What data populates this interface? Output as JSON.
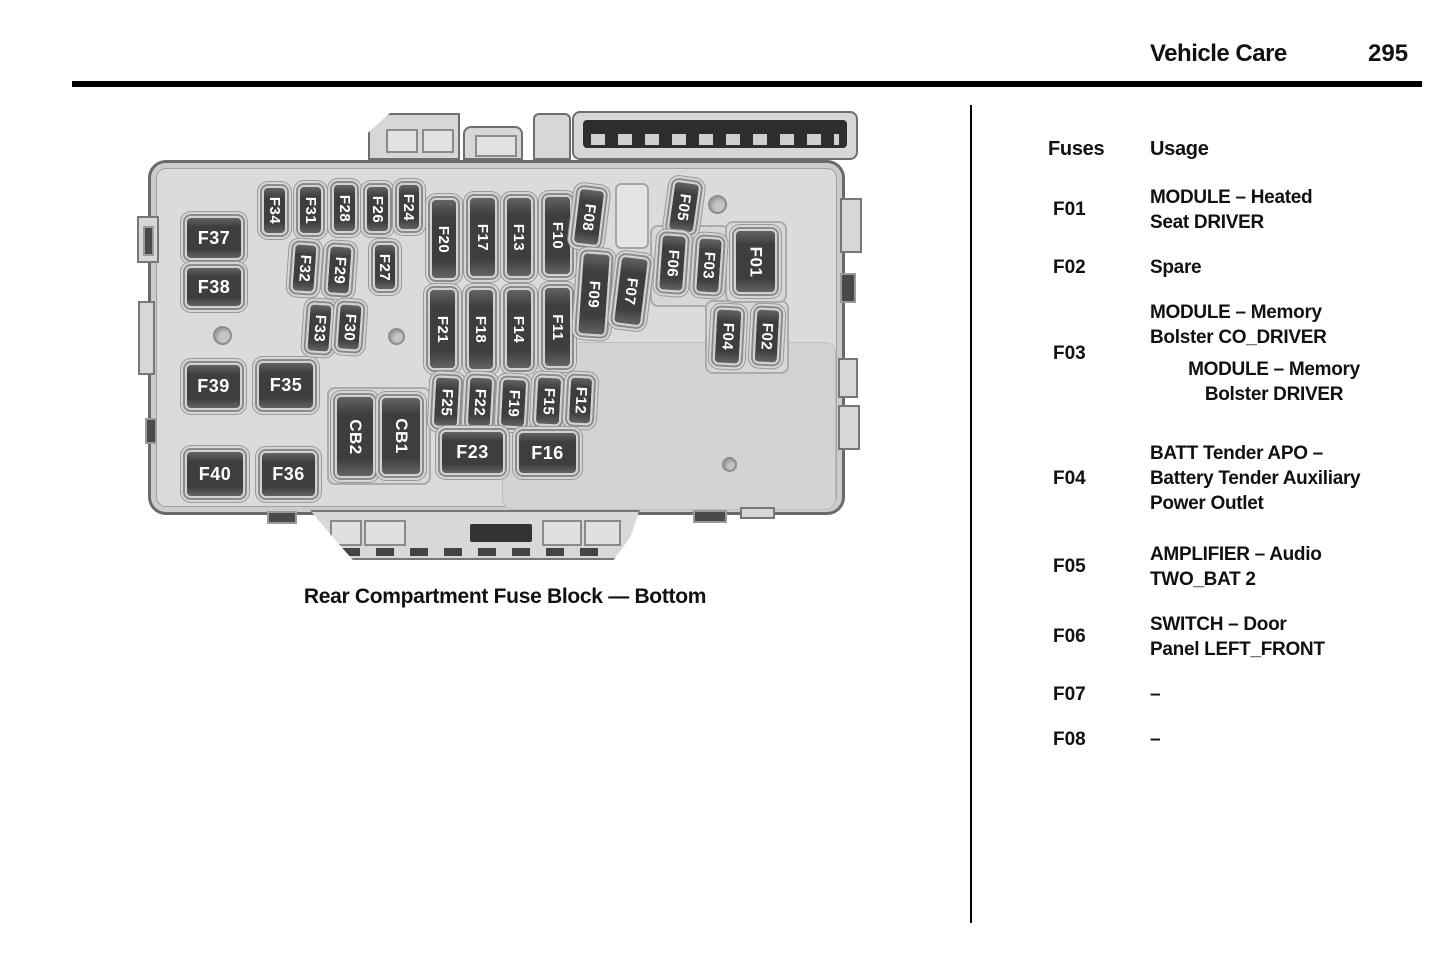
{
  "page_header": {
    "section_title": "Vehicle Care",
    "page_number": "295"
  },
  "diagram": {
    "caption": "Rear Compartment Fuse Block — Bottom",
    "fuses": [
      {
        "id": "F37",
        "x": 110,
        "y": 113,
        "w": 58,
        "h": 44,
        "o": "h"
      },
      {
        "id": "F38",
        "x": 110,
        "y": 163,
        "w": 58,
        "h": 42,
        "o": "h"
      },
      {
        "id": "F39",
        "x": 110,
        "y": 260,
        "w": 57,
        "h": 47,
        "o": "h"
      },
      {
        "id": "F35",
        "x": 182,
        "y": 258,
        "w": 58,
        "h": 49,
        "o": "h"
      },
      {
        "id": "F40",
        "x": 110,
        "y": 347,
        "w": 60,
        "h": 48,
        "o": "h"
      },
      {
        "id": "F36",
        "x": 185,
        "y": 348,
        "w": 57,
        "h": 47,
        "o": "h"
      },
      {
        "id": "F34",
        "x": 187,
        "y": 83,
        "w": 25,
        "h": 49,
        "o": "v"
      },
      {
        "id": "F31",
        "x": 223,
        "y": 82,
        "w": 25,
        "h": 50,
        "o": "v"
      },
      {
        "id": "F28",
        "x": 257,
        "y": 80,
        "w": 25,
        "h": 50,
        "o": "v"
      },
      {
        "id": "F26",
        "x": 290,
        "y": 82,
        "w": 25,
        "h": 48,
        "o": "v"
      },
      {
        "id": "F24",
        "x": 322,
        "y": 80,
        "w": 24,
        "h": 48,
        "o": "v"
      },
      {
        "id": "F32",
        "x": 217,
        "y": 140,
        "w": 25,
        "h": 50,
        "o": "v",
        "tilt": 4
      },
      {
        "id": "F29",
        "x": 252,
        "y": 142,
        "w": 25,
        "h": 50,
        "o": "v",
        "tilt": 4
      },
      {
        "id": "F27",
        "x": 298,
        "y": 140,
        "w": 24,
        "h": 48,
        "o": "v"
      },
      {
        "id": "F33",
        "x": 232,
        "y": 200,
        "w": 25,
        "h": 50,
        "o": "v",
        "tilt": 4
      },
      {
        "id": "F30",
        "x": 262,
        "y": 200,
        "w": 25,
        "h": 48,
        "o": "v",
        "tilt": 4
      },
      {
        "id": "F20",
        "x": 355,
        "y": 95,
        "w": 28,
        "h": 82,
        "o": "v"
      },
      {
        "id": "F17",
        "x": 393,
        "y": 93,
        "w": 29,
        "h": 82,
        "o": "v"
      },
      {
        "id": "F13",
        "x": 430,
        "y": 93,
        "w": 28,
        "h": 82,
        "o": "v"
      },
      {
        "id": "F10",
        "x": 468,
        "y": 92,
        "w": 29,
        "h": 81,
        "o": "v"
      },
      {
        "id": "F08",
        "x": 500,
        "y": 85,
        "w": 28,
        "h": 58,
        "o": "v",
        "tilt": 7
      },
      {
        "id": "F21",
        "x": 353,
        "y": 185,
        "w": 29,
        "h": 82,
        "o": "v"
      },
      {
        "id": "F18",
        "x": 392,
        "y": 185,
        "w": 28,
        "h": 83,
        "o": "v"
      },
      {
        "id": "F14",
        "x": 430,
        "y": 185,
        "w": 28,
        "h": 82,
        "o": "v"
      },
      {
        "id": "F11",
        "x": 468,
        "y": 183,
        "w": 29,
        "h": 82,
        "o": "v"
      },
      {
        "id": "F09",
        "x": 504,
        "y": 149,
        "w": 30,
        "h": 84,
        "o": "v",
        "tilt": 4
      },
      {
        "id": "F07",
        "x": 541,
        "y": 153,
        "w": 30,
        "h": 70,
        "o": "v",
        "tilt": 7
      },
      {
        "id": "F05",
        "x": 595,
        "y": 78,
        "w": 28,
        "h": 52,
        "o": "v",
        "tilt": 8
      },
      {
        "id": "F06",
        "x": 584,
        "y": 131,
        "w": 27,
        "h": 58,
        "o": "v",
        "tilt": 4
      },
      {
        "id": "F03",
        "x": 621,
        "y": 134,
        "w": 26,
        "h": 57,
        "o": "v",
        "tilt": 4
      },
      {
        "id": "F01",
        "x": 659,
        "y": 126,
        "w": 43,
        "h": 65,
        "o": "v",
        "fs": 17
      },
      {
        "id": "F04",
        "x": 639,
        "y": 205,
        "w": 28,
        "h": 57,
        "o": "v",
        "tilt": 3
      },
      {
        "id": "F02",
        "x": 679,
        "y": 205,
        "w": 26,
        "h": 56,
        "o": "v",
        "tilt": 3
      },
      {
        "id": "F25",
        "x": 358,
        "y": 273,
        "w": 27,
        "h": 52,
        "o": "v",
        "tilt": 3
      },
      {
        "id": "F22",
        "x": 392,
        "y": 273,
        "w": 26,
        "h": 52,
        "o": "v",
        "tilt": 3
      },
      {
        "id": "F19",
        "x": 425,
        "y": 275,
        "w": 27,
        "h": 50,
        "o": "v",
        "tilt": 3
      },
      {
        "id": "F15",
        "x": 460,
        "y": 273,
        "w": 27,
        "h": 50,
        "o": "v",
        "tilt": 3
      },
      {
        "id": "F12",
        "x": 493,
        "y": 273,
        "w": 25,
        "h": 49,
        "o": "v",
        "tilt": 3
      },
      {
        "id": "CB2",
        "x": 260,
        "y": 292,
        "w": 40,
        "h": 83,
        "o": "v",
        "fs": 17
      },
      {
        "id": "CB1",
        "x": 305,
        "y": 293,
        "w": 42,
        "h": 80,
        "o": "v",
        "fs": 17
      },
      {
        "id": "F23",
        "x": 365,
        "y": 327,
        "w": 65,
        "h": 45,
        "o": "h"
      },
      {
        "id": "F16",
        "x": 442,
        "y": 328,
        "w": 61,
        "h": 44,
        "o": "h"
      }
    ],
    "screw_holes": [
      {
        "x": 138,
        "y": 223,
        "d": 19
      },
      {
        "x": 313,
        "y": 225,
        "d": 17
      },
      {
        "x": 633,
        "y": 92,
        "d": 19
      },
      {
        "x": 647,
        "y": 354,
        "d": 15
      }
    ]
  },
  "fuse_table": {
    "col_fuses": "Fuses",
    "col_usage": "Usage",
    "rows": [
      {
        "fuse": "F01",
        "entries": [
          {
            "lines": [
              "MODULE – Heated",
              "Seat DRIVER"
            ]
          }
        ]
      },
      {
        "fuse": "F02",
        "entries": [
          {
            "lines": [
              "Spare"
            ]
          }
        ]
      },
      {
        "fuse": "F03",
        "mb": 34,
        "entries": [
          {
            "lines": [
              "MODULE – Memory",
              "Bolster CO_DRIVER"
            ]
          },
          {
            "indent": true,
            "lines": [
              "MODULE – Memory",
              "Bolster DRIVER"
            ]
          }
        ]
      },
      {
        "fuse": "F04",
        "mb": 26,
        "entries": [
          {
            "lines": [
              "BATT Tender APO –",
              "Battery Tender Auxiliary",
              "Power Outlet"
            ]
          }
        ]
      },
      {
        "fuse": "F05",
        "entries": [
          {
            "lines": [
              "AMPLIFIER – Audio",
              "TWO_BAT 2"
            ]
          }
        ]
      },
      {
        "fuse": "F06",
        "entries": [
          {
            "lines": [
              "SWITCH – Door",
              "Panel LEFT_FRONT"
            ]
          }
        ]
      },
      {
        "fuse": "F07",
        "entries": [
          {
            "lines": [
              "–"
            ]
          }
        ]
      },
      {
        "fuse": "F08",
        "entries": [
          {
            "lines": [
              "–"
            ]
          }
        ]
      }
    ]
  },
  "colors": {
    "text": "#111111",
    "fuse_fill": "#3f3f3f",
    "fuse_text": "#ffffff",
    "body_fill": "#dbdbdb"
  }
}
